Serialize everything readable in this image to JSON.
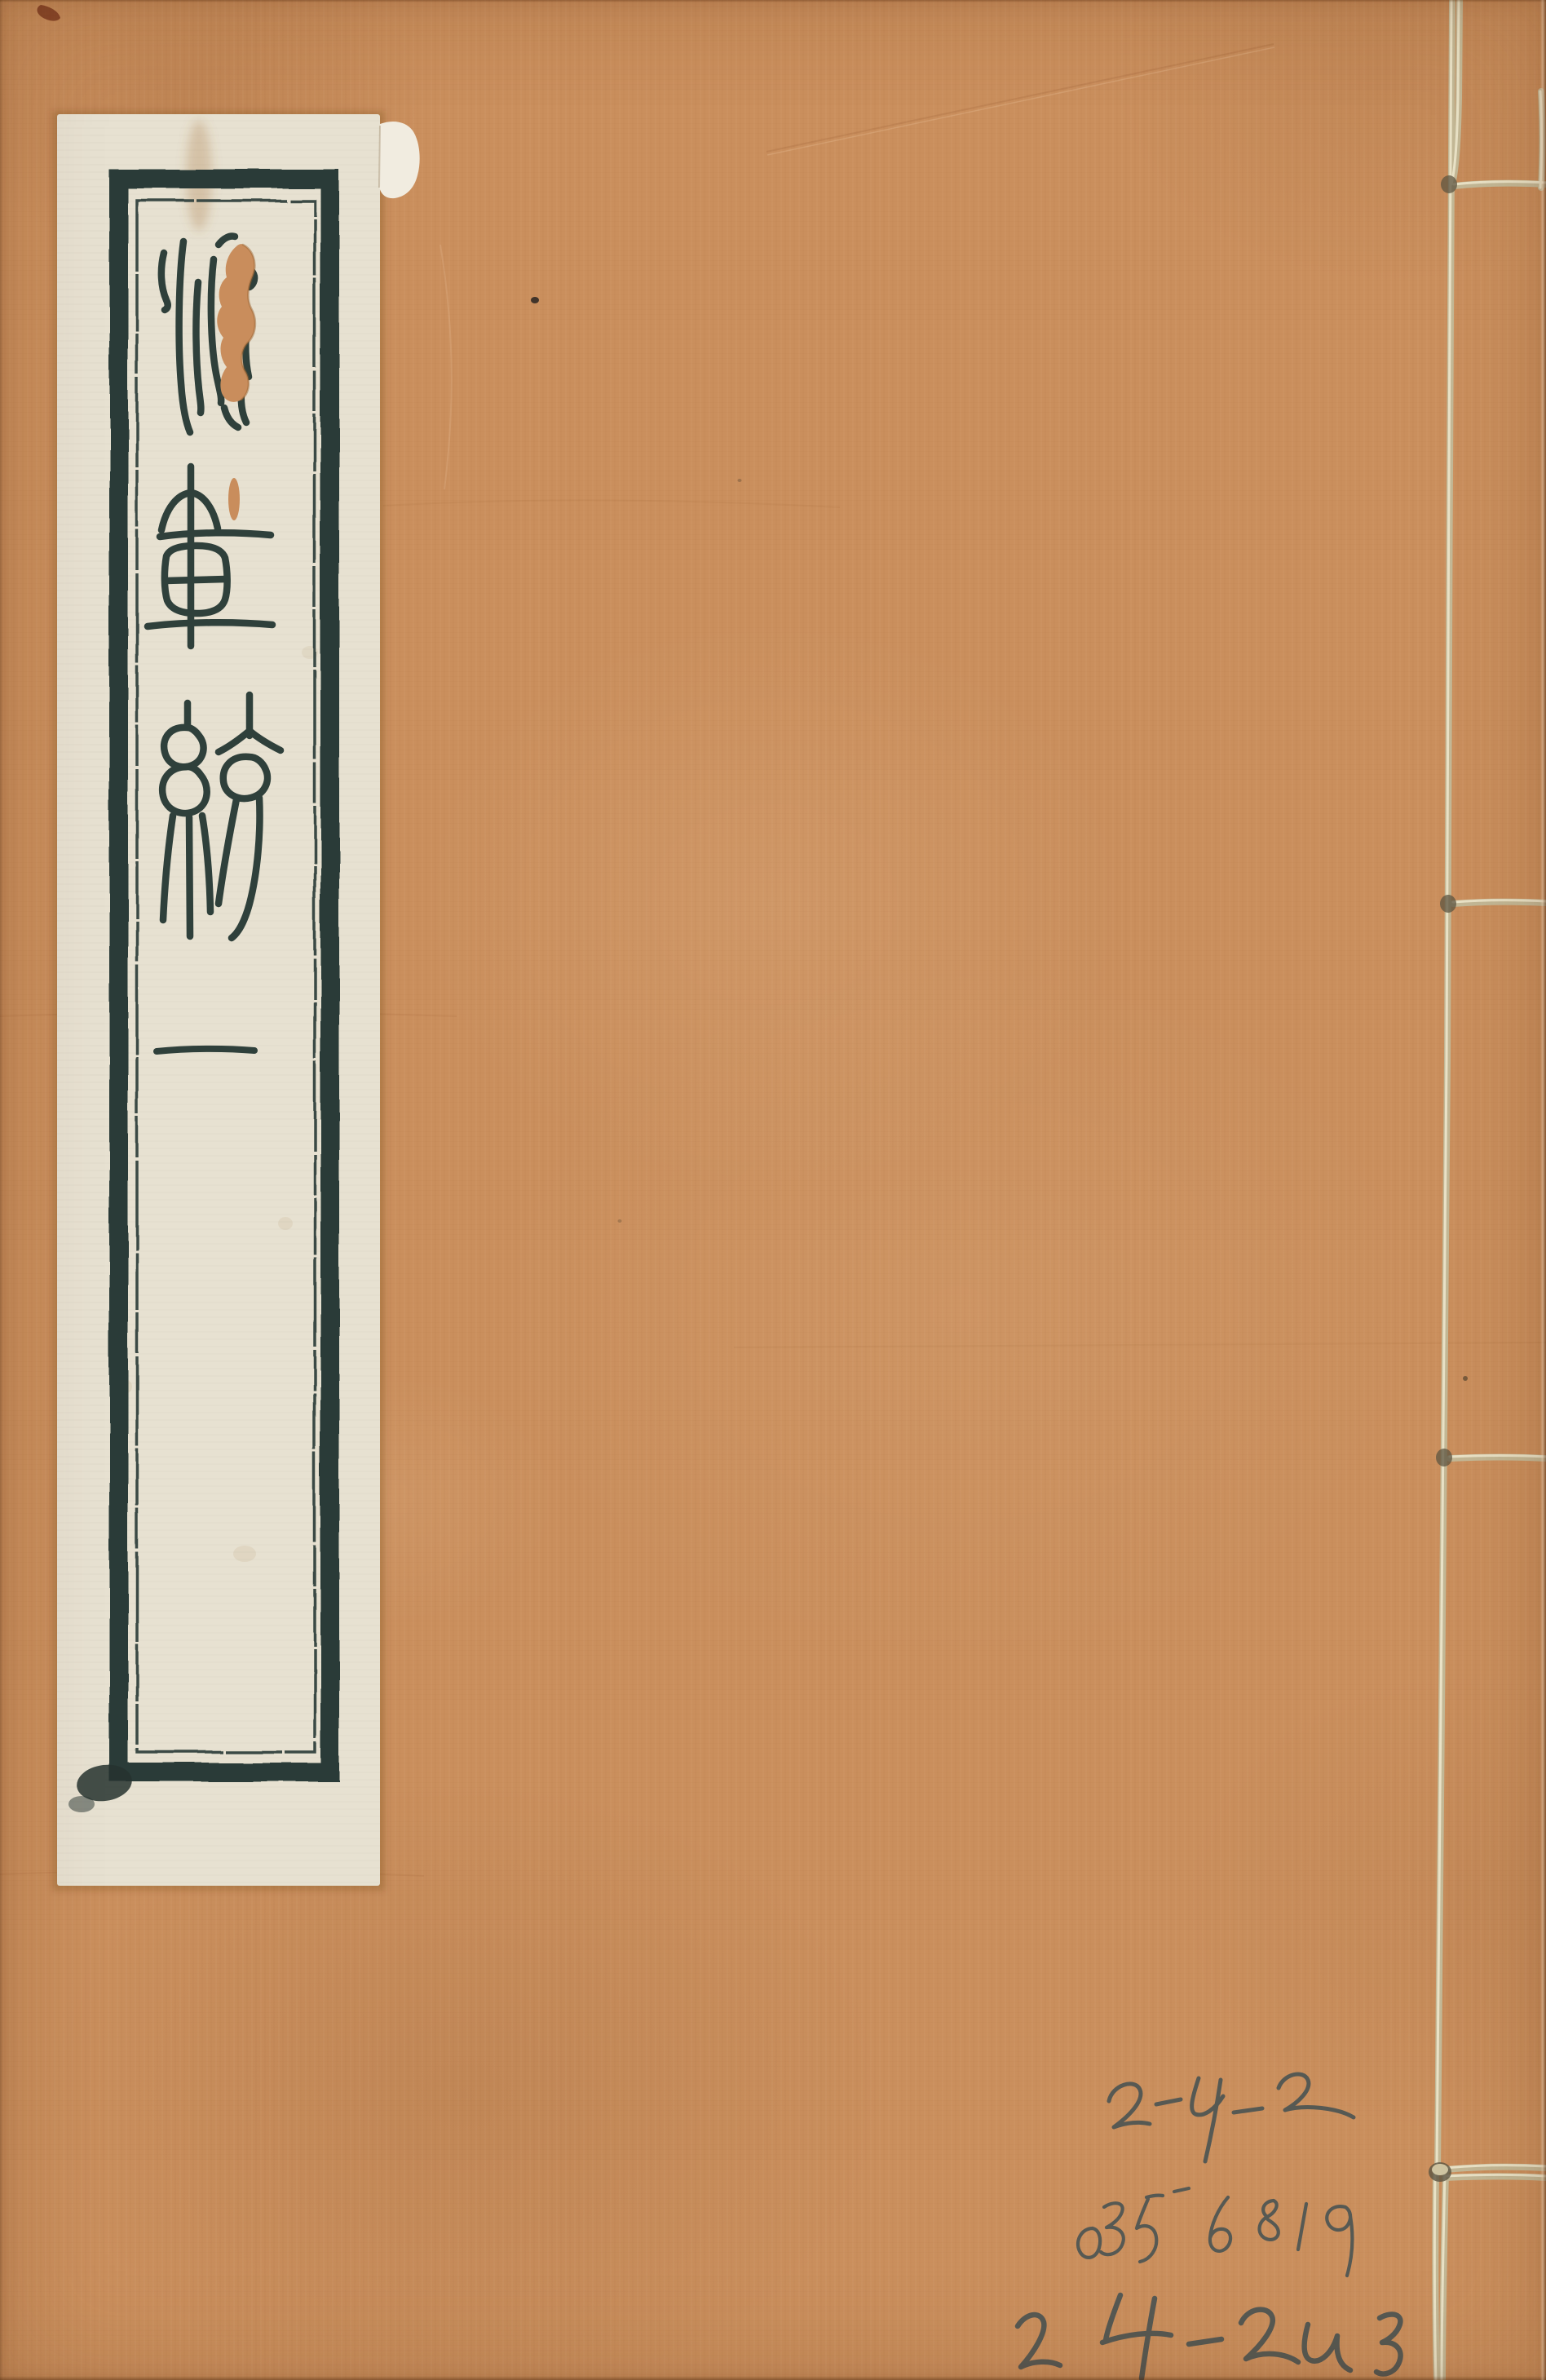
{
  "page": {
    "description": "Scanned front cover of a Chinese thread-bound (stitched) rare book",
    "cover": {
      "paper_color": "#ca8f5d",
      "condition": "plain orange-brown paper with creases and small dark specks"
    },
    "title_label": {
      "paper_color": "#e7e1d1",
      "ink_color": "#2e3d39",
      "frame_style": "double rules: thick outer border, thin inner border",
      "script": "seal script (zhuanshu), written vertically",
      "characters": [
        "(damaged character, water radical visible)",
        "畫",
        "統"
      ],
      "reading_uncertain": true,
      "volume_marker": "一",
      "damage": "wormhole tear through first character exposing orange cover; torn whitish flap at top-right corner of label; ink blob at bottom-left frame corner"
    },
    "binding": {
      "thread_color": "#d8cfb0",
      "style": "side stitching along right edge",
      "visible_stitches": 4
    },
    "annotations": {
      "medium": "pencil",
      "color": "#4d5553",
      "lines": [
        "2-4-2",
        "0356819",
        "2-4-243"
      ]
    }
  }
}
